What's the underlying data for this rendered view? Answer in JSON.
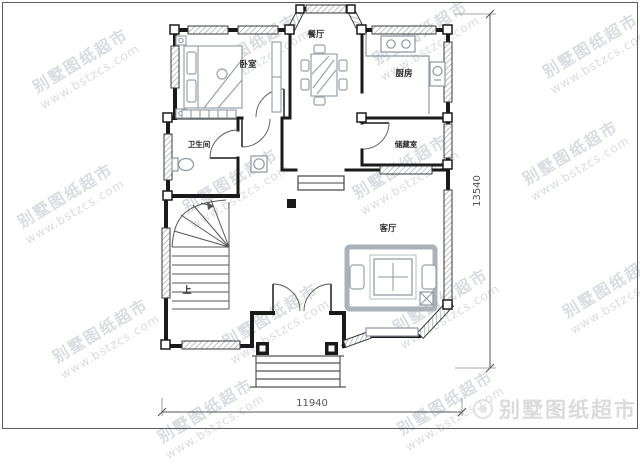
{
  "plan": {
    "rooms": {
      "bedroom": "卧室",
      "dining": "餐厅",
      "kitchen": "厨房",
      "bathroom": "卫生间",
      "storage": "储藏室",
      "living": "客厅",
      "stairs_up": "上"
    },
    "dims": {
      "width_mm": "11940",
      "height_mm": "13540"
    }
  },
  "watermark": {
    "brand": "别墅图纸超市",
    "site": "www.bstzcs.com"
  },
  "corner": {
    "brand": "别墅图纸超市",
    "logo_icon": "round-stamp-icon"
  },
  "colors": {
    "wall": "#1a1a1a",
    "furniture": "#9aa2ab",
    "watermark": "#d9dce1",
    "dimension": "#555555",
    "window_hatch": "#99a1aa"
  }
}
